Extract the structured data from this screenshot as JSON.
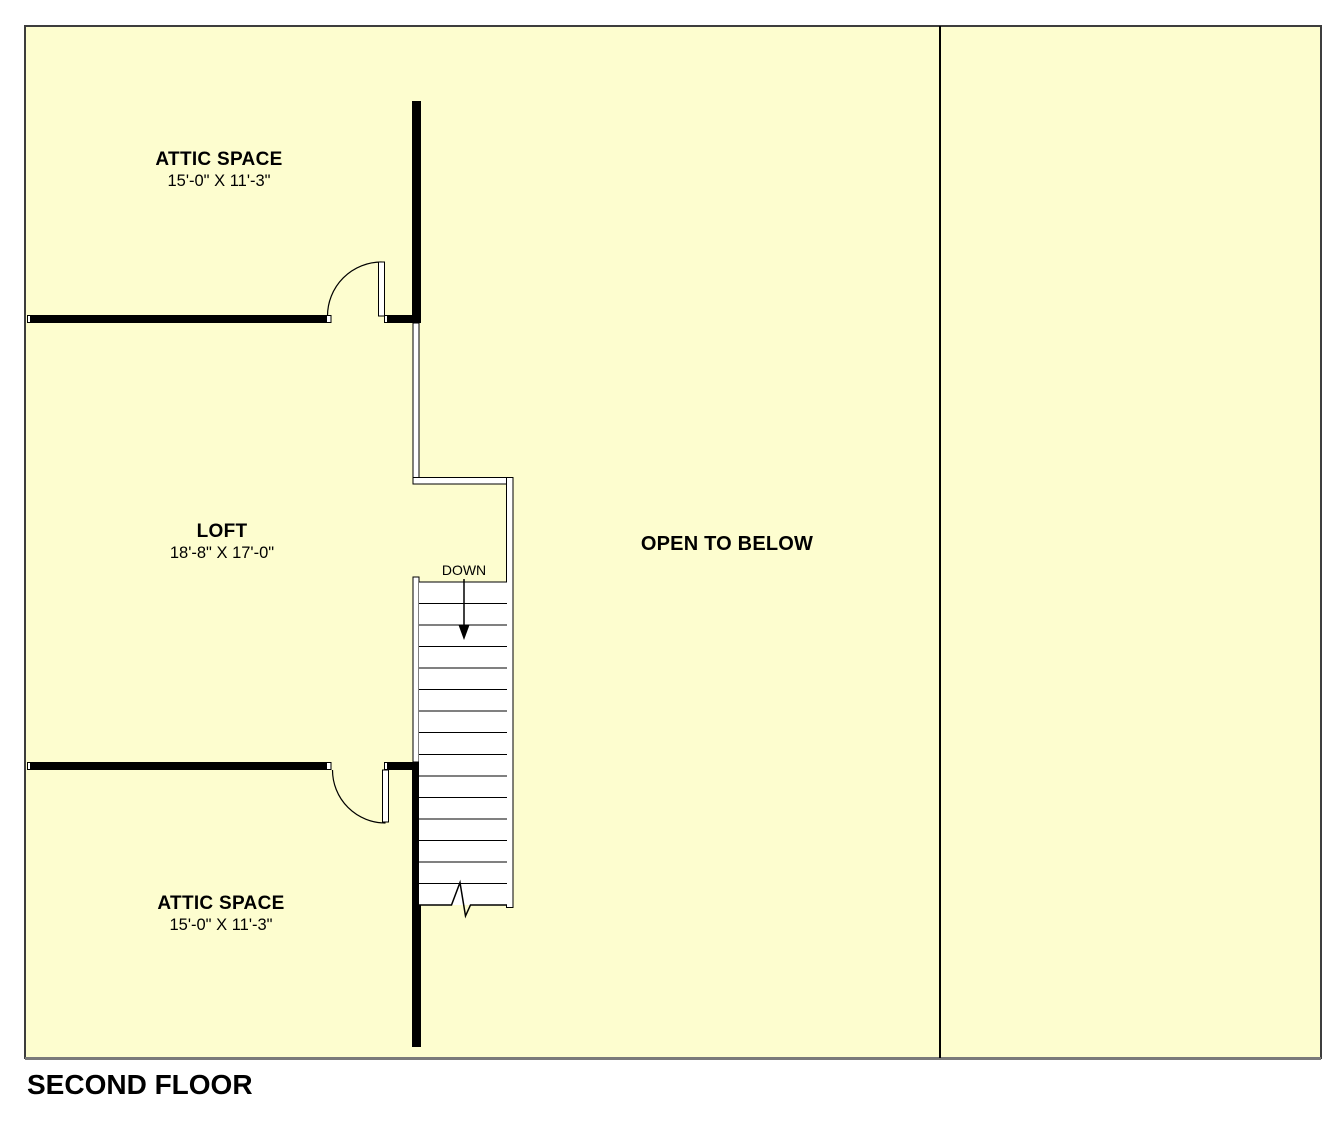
{
  "page": {
    "title": "SECOND FLOOR"
  },
  "colors": {
    "page_background": "#FFFFFF",
    "plan_background": "#FDFDCF",
    "wall": "#000000",
    "plan_border": "#3D3D3D",
    "bottom_shadow": "#7A7A7A",
    "text": "#000000"
  },
  "rooms": {
    "attic_top": {
      "name": "ATTIC SPACE",
      "dims": "15'-0\" X 11'-3\""
    },
    "loft": {
      "name": "LOFT",
      "dims": "18'-8\" X 17'-0\""
    },
    "open_to_below": {
      "name": "OPEN TO BELOW"
    },
    "attic_bottom": {
      "name": "ATTIC SPACE",
      "dims": "15'-0\" X 11'-3\""
    }
  },
  "stairs": {
    "direction_label": "DOWN"
  }
}
